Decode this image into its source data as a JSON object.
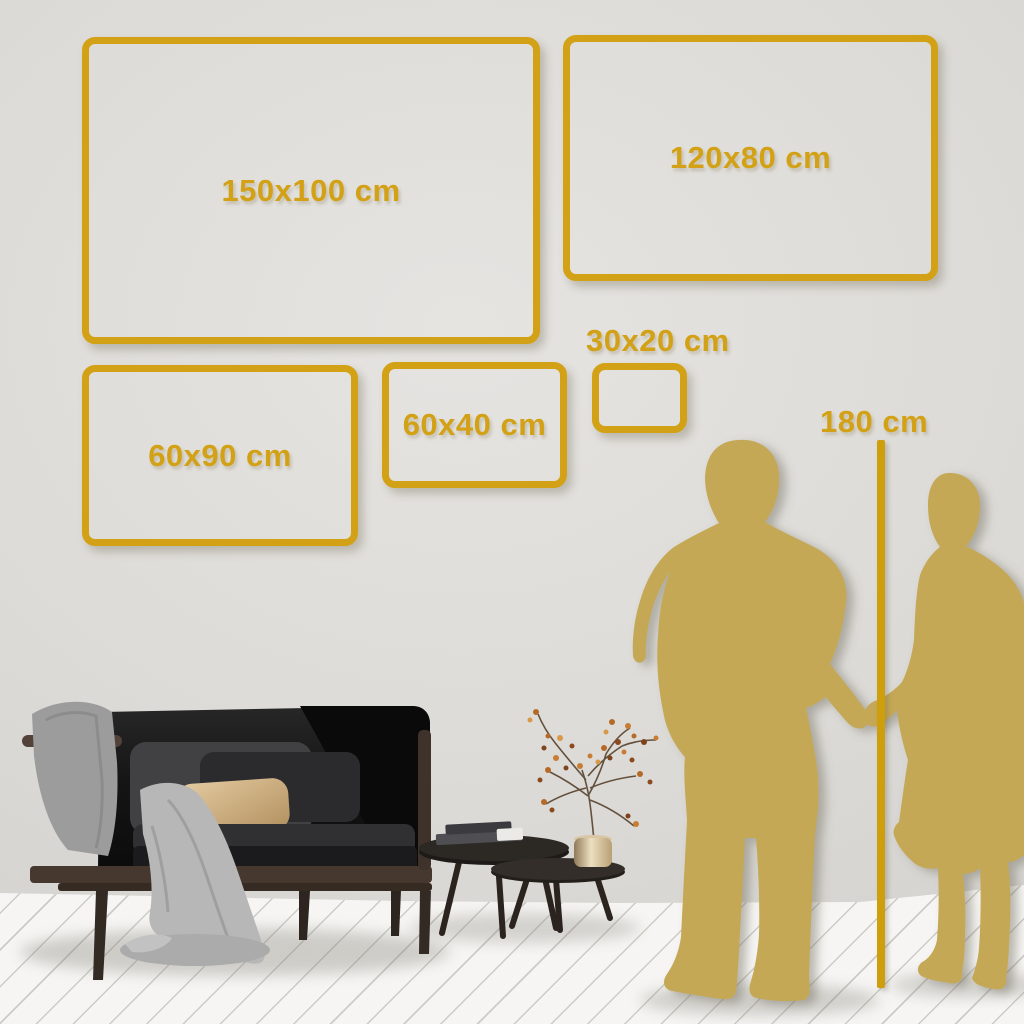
{
  "canvas_sizes": {
    "frames": [
      {
        "label": "150x100 cm"
      },
      {
        "label": "120x80 cm"
      },
      {
        "label": "60x90 cm"
      },
      {
        "label": "60x40 cm"
      },
      {
        "label": "30x20 cm"
      }
    ],
    "height_marker": {
      "label": "180 cm"
    }
  },
  "scene_objects": {
    "couple_silhouette": "man and woman holding hands",
    "furniture": [
      "dark loveseat sofa with gray blanket and beige pillow",
      "two nesting round coffee tables",
      "books",
      "brass pot with dried berry branches"
    ]
  },
  "colors": {
    "frame_gold": "#d3a115",
    "line_gold": "#cf9e0c",
    "silhouette_gold": "#c4a854",
    "wall_gray": "#dddbd7",
    "floor_white": "#f4f3f1",
    "sofa_charcoal": "#161616",
    "pillow_beige": "#d8b98e"
  }
}
